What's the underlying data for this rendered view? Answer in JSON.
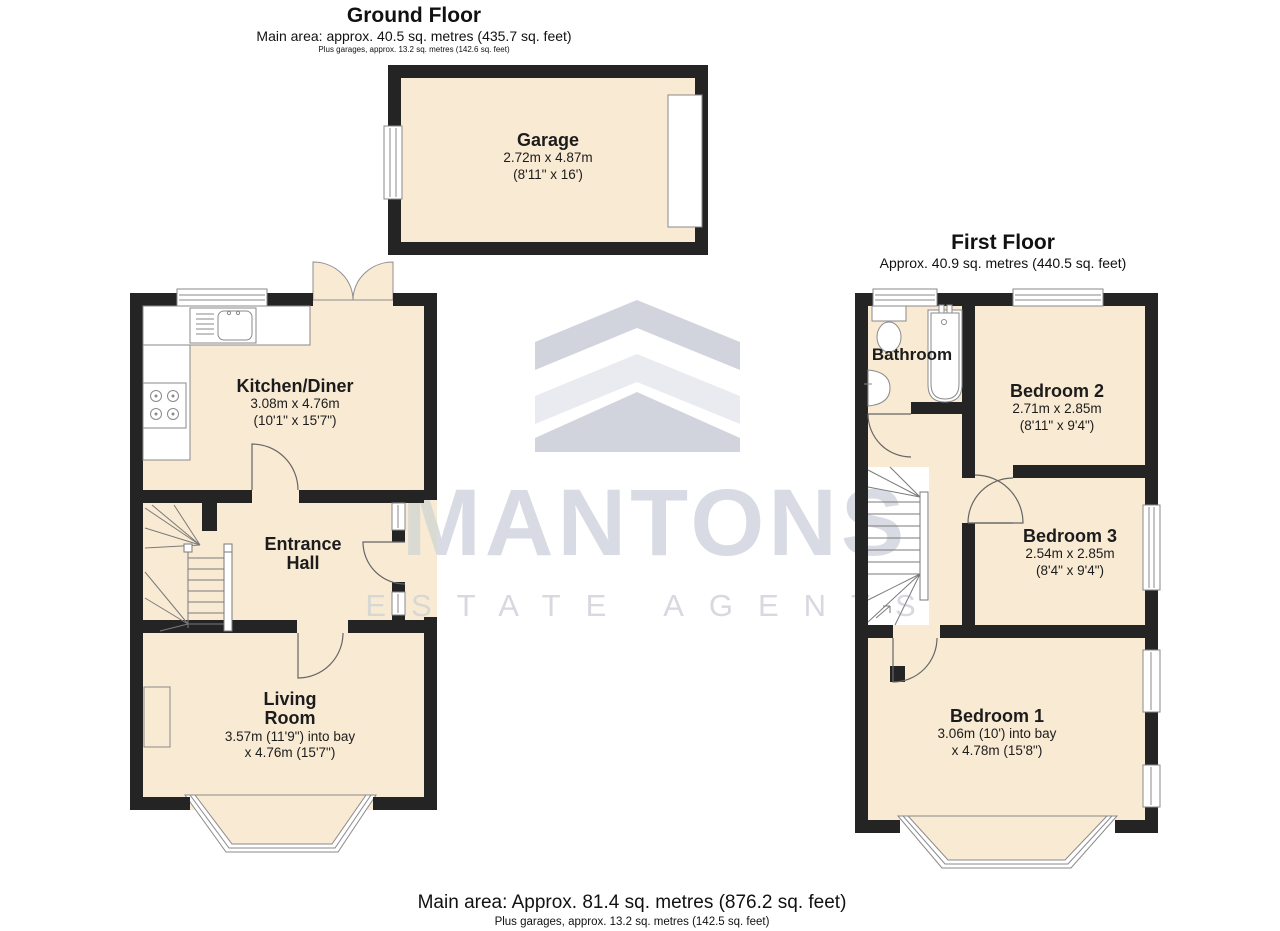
{
  "ground_floor": {
    "title": "Ground Floor",
    "area_line": "Main area: approx. 40.5 sq. metres (435.7 sq. feet)",
    "garage_line": "Plus garages, approx. 13.2 sq. metres (142.6 sq. feet)",
    "rooms": {
      "garage": {
        "name": "Garage",
        "dims1": "2.72m x 4.87m",
        "dims2": "(8'11\" x 16')"
      },
      "kitchen": {
        "name": "Kitchen/Diner",
        "dims1": "3.08m x 4.76m",
        "dims2": "(10'1\" x 15'7\")"
      },
      "hall": {
        "name": "Entrance\nHall"
      },
      "living": {
        "name": "Living\nRoom",
        "dims1": "3.57m (11'9\") into bay",
        "dims2": "x 4.76m (15'7\")"
      }
    }
  },
  "first_floor": {
    "title": "First Floor",
    "area_line": "Approx. 40.9 sq. metres (440.5 sq. feet)",
    "rooms": {
      "bathroom": {
        "name": "Bathroom"
      },
      "bedroom2": {
        "name": "Bedroom 2",
        "dims1": "2.71m x 2.85m",
        "dims2": "(8'11\" x 9'4\")"
      },
      "bedroom3": {
        "name": "Bedroom 3",
        "dims1": "2.54m x 2.85m",
        "dims2": "(8'4\" x 9'4\")"
      },
      "bedroom1": {
        "name": "Bedroom 1",
        "dims1": "3.06m (10') into bay",
        "dims2": "x 4.78m (15'8\")"
      }
    }
  },
  "footer": {
    "main": "Main area: Approx. 81.4 sq. metres (876.2 sq. feet)",
    "plus": "Plus garages, approx. 13.2 sq. metres (142.5 sq. feet)"
  },
  "watermark": {
    "brand": "MANTONS",
    "tagline": "ESTATE AGENTS"
  },
  "colors": {
    "room_fill": "#f9ead3",
    "wall": "#242424",
    "watermark_gray": "#d9dbe4"
  }
}
